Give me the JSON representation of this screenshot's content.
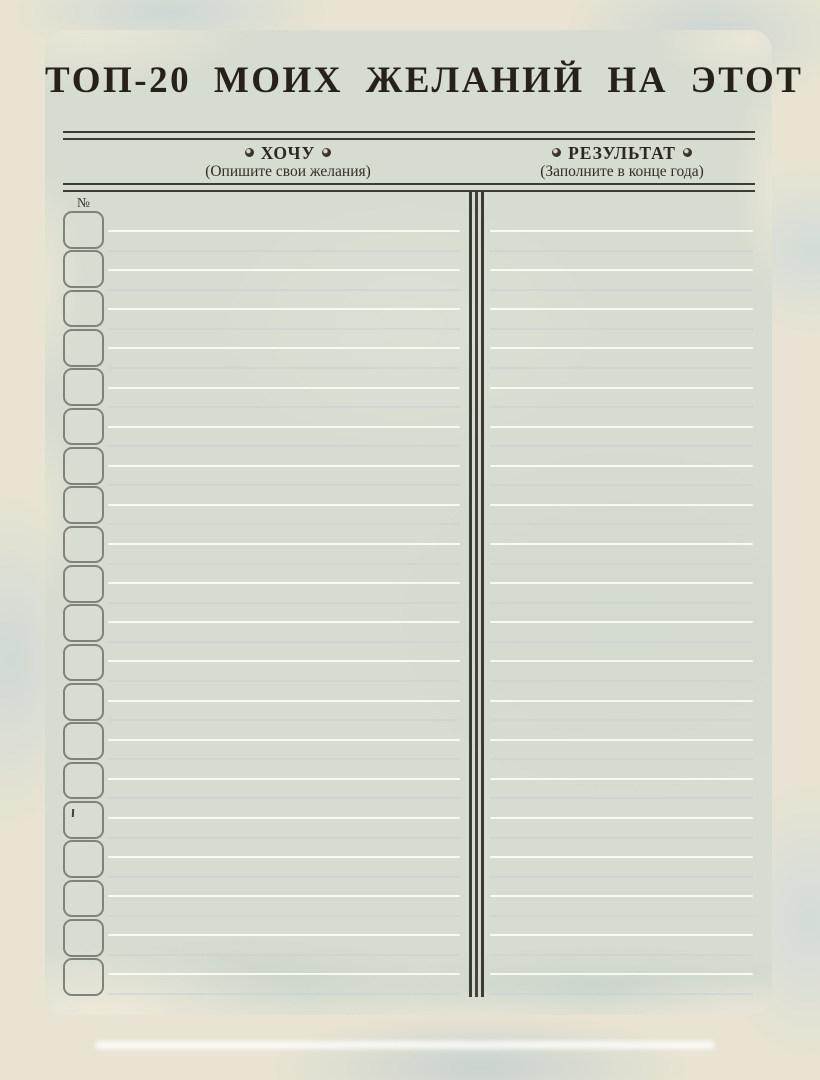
{
  "title": "ТОП-20 МОИХ ЖЕЛАНИЙ НА ЭТОТ ГОД",
  "columns": {
    "want": {
      "label": "ХОЧУ",
      "subtitle": "(Опишите свои желания)"
    },
    "result": {
      "label": "РЕЗУЛЬТАТ",
      "subtitle": "(Заполните в конце года)"
    }
  },
  "number_column_header": "№",
  "icons": {
    "header_ornament": "rosette-icon"
  },
  "table": {
    "row_count": 20,
    "writing_lines_per_column": 40,
    "rows": [
      {
        "number": "",
        "want": "",
        "result": ""
      },
      {
        "number": "",
        "want": "",
        "result": ""
      },
      {
        "number": "",
        "want": "",
        "result": ""
      },
      {
        "number": "",
        "want": "",
        "result": ""
      },
      {
        "number": "",
        "want": "",
        "result": ""
      },
      {
        "number": "",
        "want": "",
        "result": ""
      },
      {
        "number": "",
        "want": "",
        "result": ""
      },
      {
        "number": "",
        "want": "",
        "result": ""
      },
      {
        "number": "",
        "want": "",
        "result": ""
      },
      {
        "number": "",
        "want": "",
        "result": ""
      },
      {
        "number": "",
        "want": "",
        "result": ""
      },
      {
        "number": "",
        "want": "",
        "result": ""
      },
      {
        "number": "",
        "want": "",
        "result": ""
      },
      {
        "number": "",
        "want": "",
        "result": ""
      },
      {
        "number": "",
        "want": "",
        "result": ""
      },
      {
        "number": "",
        "want": "",
        "result": ""
      },
      {
        "number": "",
        "want": "",
        "result": ""
      },
      {
        "number": "",
        "want": "",
        "result": ""
      },
      {
        "number": "",
        "want": "",
        "result": ""
      },
      {
        "number": "",
        "want": "",
        "result": ""
      }
    ]
  },
  "colors": {
    "ink": "#2e2921",
    "rule": "#3c3a31",
    "box_border": "#7f837b",
    "page_background": "#d6dccf",
    "paper_edge": "#e8e3d2",
    "writing_line_bright": "#f8fbf0",
    "writing_line_dim": "#cbd0d1"
  }
}
